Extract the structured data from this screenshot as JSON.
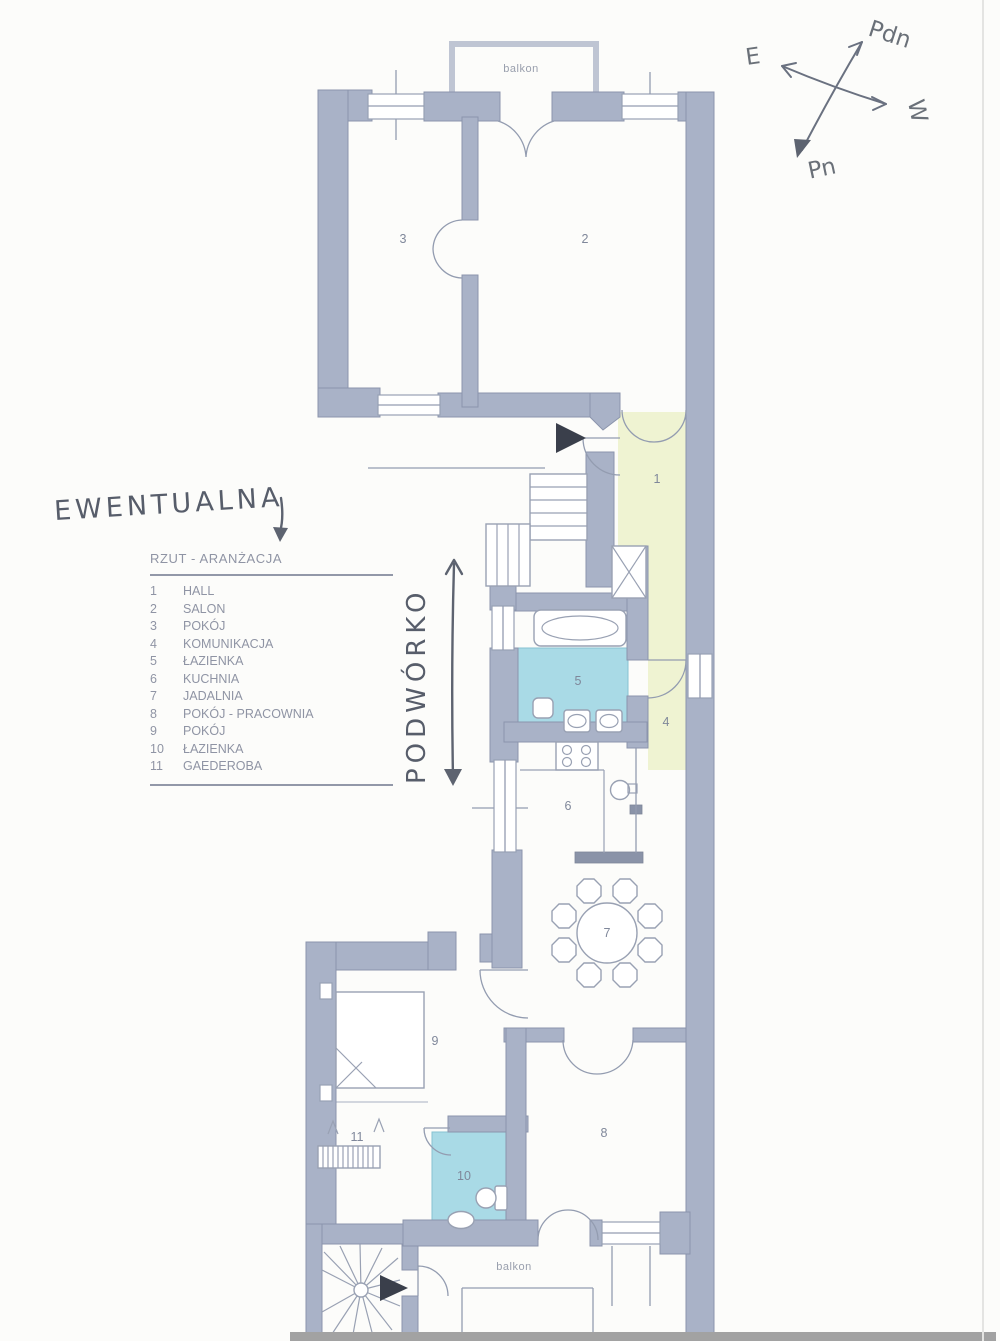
{
  "compass": {
    "e": "E",
    "pdn": "Pdn",
    "w": "W",
    "pn": "Pn"
  },
  "handwriting": {
    "note": "EWENTUALNA",
    "courtyard": "PODWÓRKO"
  },
  "legend": {
    "title": "RZUT - ARANŻACJA",
    "items": [
      {
        "num": "1",
        "label": "HALL"
      },
      {
        "num": "2",
        "label": "SALON"
      },
      {
        "num": "3",
        "label": "POKÓJ"
      },
      {
        "num": "4",
        "label": "KOMUNIKACJA"
      },
      {
        "num": "5",
        "label": "ŁAZIENKA"
      },
      {
        "num": "6",
        "label": "KUCHNIA"
      },
      {
        "num": "7",
        "label": "JADALNIA"
      },
      {
        "num": "8",
        "label": "POKÓJ - PRACOWNIA"
      },
      {
        "num": "9",
        "label": "POKÓJ"
      },
      {
        "num": "10",
        "label": "ŁAZIENKA"
      },
      {
        "num": "11",
        "label": "GAEDEROBA"
      }
    ]
  },
  "plan": {
    "balcony_top_label": "balkon",
    "balcony_bottom_label": "balkon"
  },
  "colors": {
    "wall": "#a9b2c7",
    "wall_edge": "#8b94ac",
    "bathroom_fill": "#a9dae6",
    "hall_fill": "#eff3d2",
    "pencil": "#575d6a",
    "line": "#8f98ac"
  }
}
